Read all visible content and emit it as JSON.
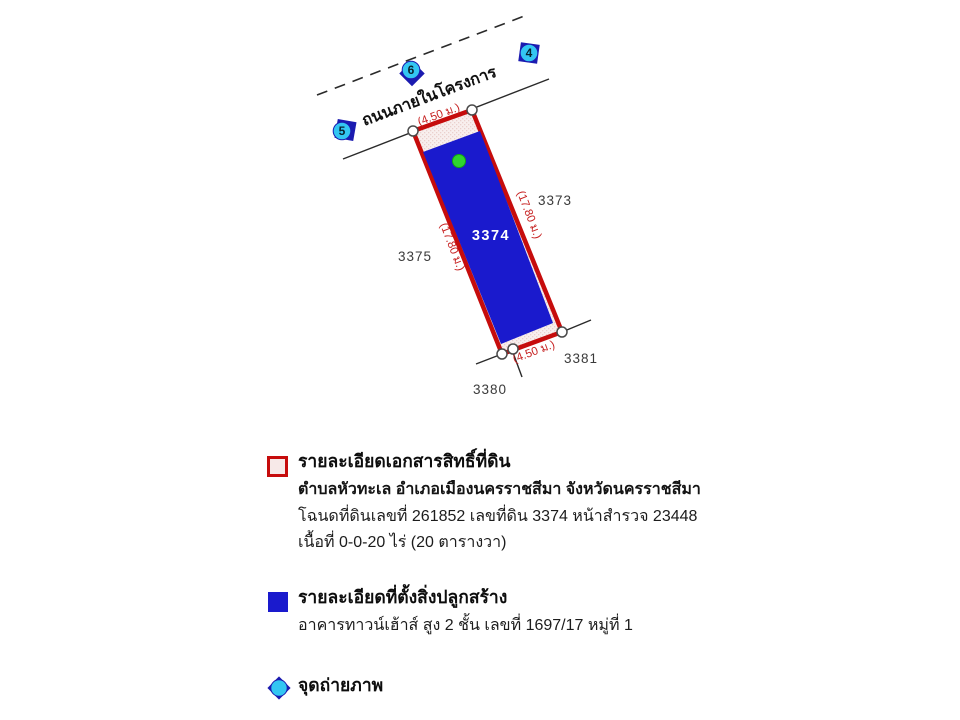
{
  "diagram": {
    "road_label": "ถนนภายในโครงการ",
    "plot": {
      "number": "3374",
      "width_top": "(4.50 ม.)",
      "width_bottom": "(4.50 ม.)",
      "length_left": "(17.80 ม.)",
      "length_right": "(17.80 ม.)"
    },
    "neighbors": {
      "right": "3373",
      "left": "3375",
      "bottom_left": "3380",
      "bottom_right": "3381"
    },
    "photo_points": [
      {
        "number": "4"
      },
      {
        "number": "6"
      },
      {
        "number": "5"
      }
    ]
  },
  "legend": {
    "land_title": {
      "heading": "รายละเอียดเอกสารสิทธิ์ที่ดิน",
      "location": "ตำบลหัวทะเล อำเภอเมืองนครราชสีมา จังหวัดนครราชสีมา",
      "deed": "โฉนดที่ดินเลขที่ 261852 เลขที่ดิน 3374 หน้าสำรวจ 23448",
      "area": "เนื้อที่ 0-0-20 ไร่ (20 ตารางวา)"
    },
    "building": {
      "heading": "รายละเอียดที่ตั้งสิ่งปลูกสร้าง",
      "detail": "อาคารทาวน์เฮ้าส์ สูง 2 ชั้น เลขที่ 1697/17 หมู่ที่ 1"
    },
    "photo_point_label": "จุดถ่ายภาพ"
  },
  "colors": {
    "plot_border_red": "#c60c0c",
    "plot_fill_pink": "#f7e9e8",
    "building_blue": "#1a1acd",
    "photo_marker_cyan": "#33c6f2",
    "photo_marker_dark_blue": "#1b1bb0",
    "photo_dot_green": "#2fd42f",
    "dimension_text_red": "#c62020"
  }
}
